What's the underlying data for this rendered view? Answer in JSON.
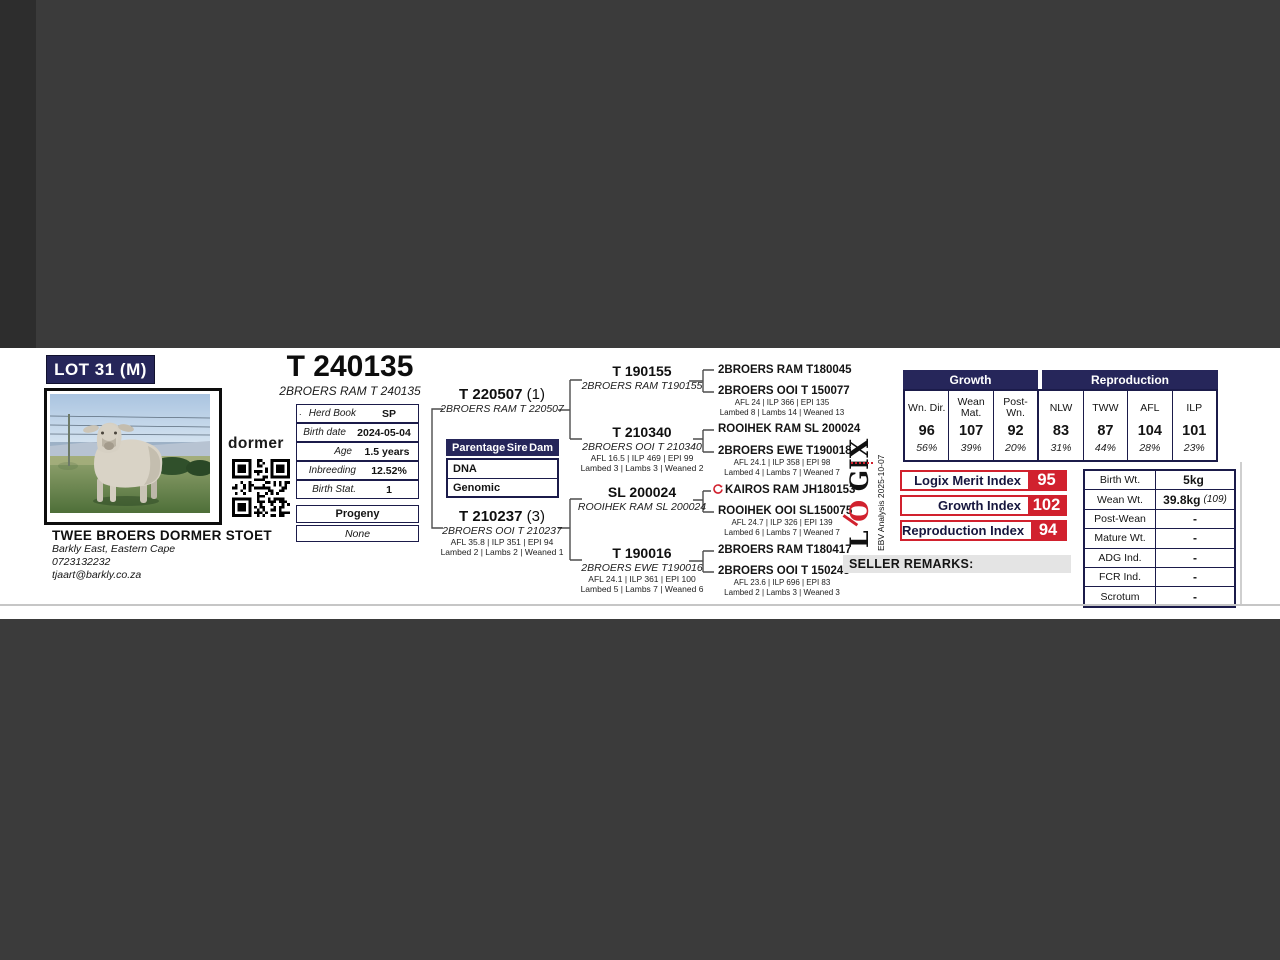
{
  "page": {
    "lot": "LOT 31 (M)",
    "animal_id": "T 240135",
    "animal_name": "2BROERS RAM T 240135"
  },
  "breeder": {
    "logo": "dormer",
    "name": "TWEE BROERS DORMER STOET",
    "location": "Barkly East, Eastern Cape",
    "phone": "0723132232",
    "email": "tjaart@barkly.co.za"
  },
  "details": {
    "bullet": ".",
    "rows": [
      {
        "label": "Herd Book",
        "value": "SP"
      },
      {
        "label": "Birth date",
        "value": "2024-05-04"
      },
      {
        "label": "Age",
        "value": "1.5 years"
      },
      {
        "label": "Inbreeding",
        "value": "12.52%"
      },
      {
        "label": "Birth Stat.",
        "value": "1"
      }
    ],
    "progeny_header": "Progeny",
    "progeny_value": "None"
  },
  "parentage": {
    "col1": "Parentage",
    "col2": "Sire",
    "col3": "Dam",
    "rows": [
      {
        "label": "DNA"
      },
      {
        "label": "Genomic"
      }
    ]
  },
  "pedigree": {
    "gen1": [
      {
        "id": "T 220507",
        "suffix": "(1)",
        "name": "2BROERS RAM T 220507"
      },
      {
        "id": "T 210237",
        "suffix": "(3)",
        "name": "2BROERS OOI T 210237",
        "stats": "AFL 35.8 | ILP 351 | EPI 94",
        "lambing": "Lambed 2 | Lambs 2 | Weaned 1"
      }
    ],
    "gen2": [
      {
        "id": "T 190155",
        "name": "2BROERS RAM T190155"
      },
      {
        "id": "T 210340",
        "name": "2BROERS OOI T 210340",
        "stats": "AFL 16.5 | ILP 469 | EPI 99",
        "lambing": "Lambed 3 | Lambs 3 | Weaned 2"
      },
      {
        "id": "SL 200024",
        "name": "ROOIHEK RAM SL 200024"
      },
      {
        "id": "T 190016",
        "name": "2BROERS EWE T190016",
        "stats": "AFL 24.1 | ILP 361 | EPI 100",
        "lambing": "Lambed 5 | Lambs 7 | Weaned 6"
      }
    ],
    "gen3": [
      {
        "name": "2BROERS RAM T180045"
      },
      {
        "name": "2BROERS OOI T 150077",
        "stats": "AFL 24 | ILP 366 | EPI 135",
        "lambing": "Lambed 8 | Lambs 14 | Weaned 13"
      },
      {
        "name": "ROOIHEK RAM SL 200024"
      },
      {
        "name": "2BROERS EWE T190018",
        "stats": "AFL 24.1 | ILP 358 | EPI 98",
        "lambing": "Lambed 4 | Lambs 7 | Weaned 7"
      },
      {
        "name": "KAIROS RAM JH180153",
        "genomic_tested": "true"
      },
      {
        "name": "ROOIHEK OOI SL150075",
        "stats": "AFL 24.7 | ILP 326 | EPI 139",
        "lambing": "Lambed 6 | Lambs 7 | Weaned 7"
      },
      {
        "name": "2BROERS RAM T180417"
      },
      {
        "name": "2BROERS OOI T 150243",
        "stats": "AFL 23.6 | ILP 696 | EPI 83",
        "lambing": "Lambed 2 | Lambs 3 | Weaned 3"
      }
    ]
  },
  "indices_table": {
    "growth_header": "Growth",
    "reproduction_header": "Reproduction",
    "columns": [
      {
        "label": "Wn. Dir.",
        "value": "96",
        "accuracy": "56%"
      },
      {
        "label": "Wean Mat.",
        "value": "107",
        "accuracy": "39%"
      },
      {
        "label": "Post- Wn.",
        "value": "92",
        "accuracy": "20%"
      },
      {
        "label": "NLW",
        "value": "83",
        "accuracy": "31%"
      },
      {
        "label": "TWW",
        "value": "87",
        "accuracy": "44%"
      },
      {
        "label": "AFL",
        "value": "104",
        "accuracy": "28%"
      },
      {
        "label": "ILP",
        "value": "101",
        "accuracy": "23%"
      }
    ]
  },
  "logix": {
    "logo_l": "L",
    "logo_o": "O",
    "logo_gix": "GIX",
    "analysis": "EBV Analysis 2025-10-07",
    "badges": [
      {
        "label": "Logix Merit Index",
        "value": "95"
      },
      {
        "label": "Growth Index",
        "value": "102"
      },
      {
        "label": "Reproduction Index",
        "value": "94"
      }
    ]
  },
  "seller_remarks_label": "SELLER REMARKS:",
  "weights": {
    "rows": [
      {
        "label": "Birth Wt.",
        "value": "5kg",
        "note": ""
      },
      {
        "label": "Wean Wt.",
        "value": "39.8kg",
        "note": "(109)"
      },
      {
        "label": "Post-Wean",
        "value": "-",
        "note": ""
      },
      {
        "label": "Mature Wt.",
        "value": "-",
        "note": ""
      },
      {
        "label": "ADG Ind.",
        "value": "-",
        "note": ""
      },
      {
        "label": "FCR Ind.",
        "value": "-",
        "note": ""
      },
      {
        "label": "Scrotum",
        "value": "-",
        "note": ""
      }
    ]
  },
  "colors": {
    "navy": "#26265a",
    "red": "#d1212e",
    "viewer_bg": "#3b3b3b"
  }
}
